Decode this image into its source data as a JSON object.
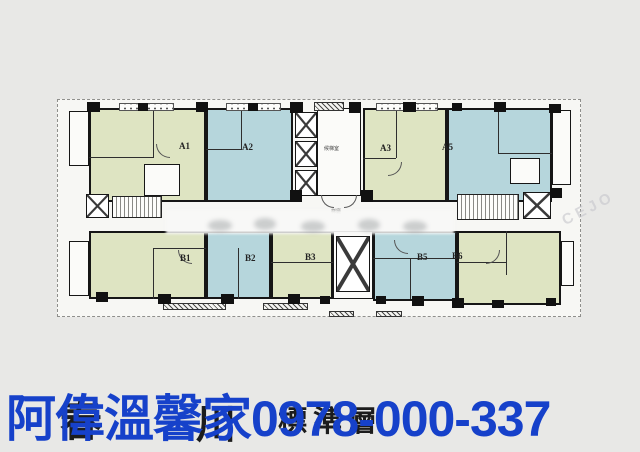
{
  "canvas": {
    "width": 640,
    "height": 452,
    "background": "#e8e8e6"
  },
  "floor_plan": {
    "units": [
      {
        "id": "A1",
        "color_key": "green"
      },
      {
        "id": "A2",
        "color_key": "blue"
      },
      {
        "id": "A3",
        "color_key": "green"
      },
      {
        "id": "A5",
        "color_key": "blue"
      },
      {
        "id": "B1",
        "color_key": "green"
      },
      {
        "id": "B2",
        "color_key": "blue"
      },
      {
        "id": "B3",
        "color_key": "green"
      },
      {
        "id": "B5",
        "color_key": "blue"
      },
      {
        "id": "B6",
        "color_key": "green"
      }
    ],
    "labels": {
      "elevator_lobby": "候梯室",
      "stair_hall": "梯廳"
    },
    "colors": {
      "unit_green": "#dee4c2",
      "unit_blue": "#b6d6dc",
      "wall": "#161616",
      "sheet": "#f7f7f4"
    }
  },
  "overlay": {
    "agent_watermark": {
      "text": "阿偉溫馨家0978-000-337",
      "color": "#1641ca"
    },
    "background_title_fragments": [
      "春",
      "川",
      "標準層"
    ],
    "ghost_watermark": "CEJO"
  }
}
